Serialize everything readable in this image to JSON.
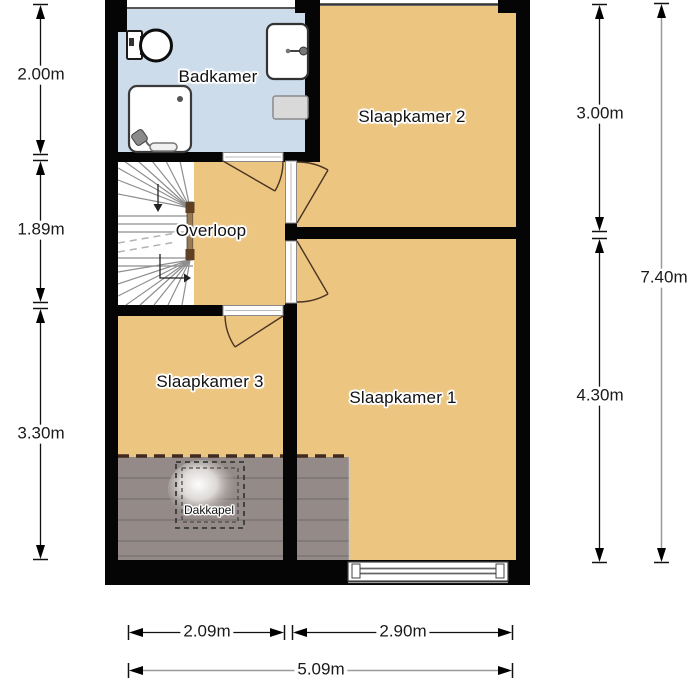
{
  "floorplan": {
    "rooms": [
      {
        "name": "badkamer",
        "label": "Badkamer"
      },
      {
        "name": "slaapkamer-2",
        "label": "Slaapkamer 2"
      },
      {
        "name": "overloop",
        "label": "Overloop"
      },
      {
        "name": "slaapkamer-3",
        "label": "Slaapkamer 3"
      },
      {
        "name": "slaapkamer-1",
        "label": "Slaapkamer 1"
      },
      {
        "name": "dakkapel",
        "label": "Dakkapel"
      }
    ],
    "dimensions": {
      "left": [
        "2.00m",
        "1.89m",
        "3.30m"
      ],
      "right_segments": [
        "3.00m",
        "4.30m"
      ],
      "right_total": "7.40m",
      "bottom_segments": [
        "2.09m",
        "2.90m"
      ],
      "bottom_total": "5.09m"
    },
    "fixtures": [
      "toilet",
      "sink",
      "shower",
      "radiator",
      "winder-stairs",
      "dormer",
      "window"
    ],
    "colors": {
      "floor_tan": "#ecc580",
      "bathroom_blue": "#cddceb",
      "roof_slope_gray": "#948b88",
      "wall_black": "#050505",
      "dimension_gray": "#999999",
      "door_arc_brown": "#4a3423"
    }
  }
}
